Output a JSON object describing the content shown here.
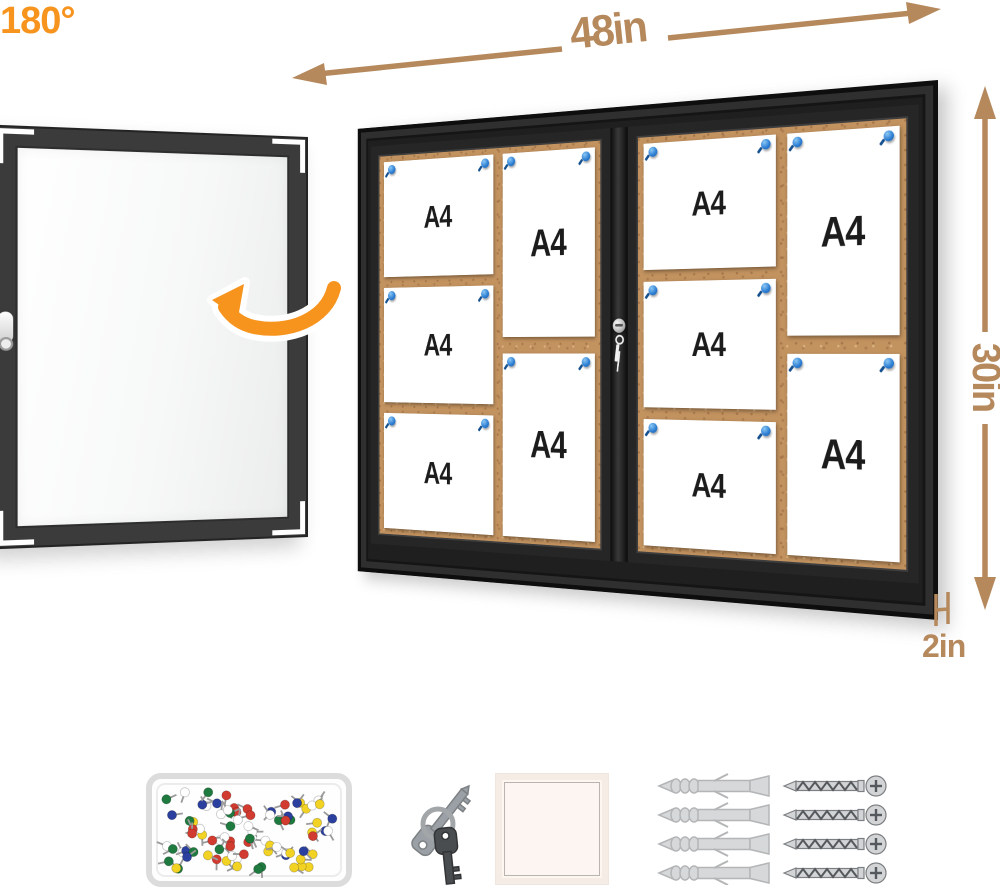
{
  "product": {
    "annotations": {
      "width_label": "48in",
      "height_label": "30in",
      "depth_label": "2in",
      "rotation_label": "180°"
    },
    "paper_label": "A4",
    "doors": [
      {
        "left_column": [
          "A4",
          "A4",
          "A4"
        ],
        "right_column": [
          "A4",
          "A4"
        ]
      },
      {
        "left_column": [
          "A4",
          "A4",
          "A4"
        ],
        "right_column": [
          "A4",
          "A4"
        ]
      }
    ]
  },
  "colors": {
    "dimension_tan": "#b6895d",
    "rotation_orange": "#f7941e",
    "frame_black": "#1f1f1f",
    "door_frame_gray": "#3b3b3b",
    "cork": "#c2925f",
    "paper_white": "#ffffff",
    "pin_blue": "#1a5aa8"
  },
  "accessories": {
    "pushpin_box": {
      "name": "pushpin-box",
      "pin_count": 85,
      "pin_colors": [
        "#d23b2f",
        "#2b3f9e",
        "#1f7a3f",
        "#f2d324",
        "#ffffff"
      ]
    },
    "keys": {
      "name": "keys",
      "count": 2
    },
    "adhesive_pad": {
      "name": "adhesive-pad"
    },
    "wall_anchors": {
      "name": "wall-anchors",
      "count": 4
    },
    "screws": {
      "name": "screws",
      "count": 4
    }
  }
}
